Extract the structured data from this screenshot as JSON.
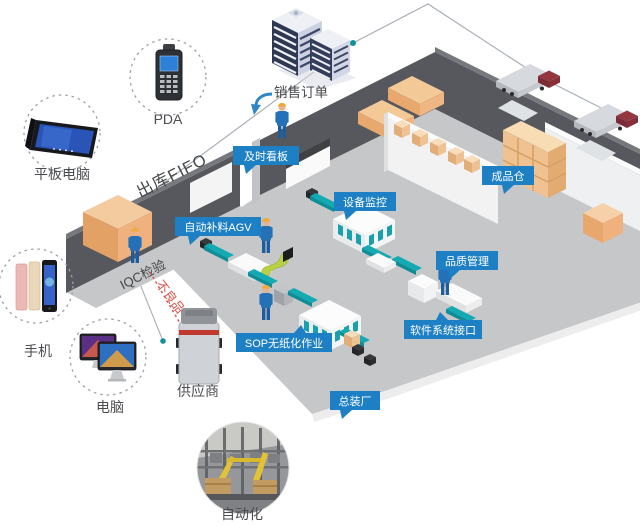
{
  "flow_texts": {
    "sales_order": "销售订单",
    "outbound_fifo": "出库FIFO",
    "iqc_inspection": "IQC检验",
    "defective": "不良品"
  },
  "devices": [
    {
      "id": "pda",
      "label": "PDA"
    },
    {
      "id": "tablet",
      "label": "平板电脑"
    },
    {
      "id": "phone",
      "label": "手机"
    },
    {
      "id": "computer",
      "label": "电脑"
    }
  ],
  "external": {
    "supplier": "供应商",
    "automation": "自动化"
  },
  "factory_tags": [
    {
      "id": "jit-board",
      "label": "及时看板"
    },
    {
      "id": "auto-replenish-agv",
      "label": "自动补料AGV"
    },
    {
      "id": "equipment-monitoring",
      "label": "设备监控"
    },
    {
      "id": "finished-goods-warehouse",
      "label": "成品仓"
    },
    {
      "id": "quality-management",
      "label": "品质管理"
    },
    {
      "id": "software-system-interface",
      "label": "软件系统接口"
    },
    {
      "id": "sop-paperless",
      "label": "SOP无纸化作业"
    },
    {
      "id": "final-assembly-plant",
      "label": "总装厂"
    }
  ],
  "colors": {
    "tag_blue": "#1e80c4",
    "conveyor_teal": "#14aab4",
    "box_orange": "#efb27f",
    "defective_red": "#d9534a",
    "wall_dark": "#57585d",
    "floor_gray": "#c6c7c9",
    "worker_blue": "#2571b8",
    "arrow_blue": "#2e86c6"
  }
}
